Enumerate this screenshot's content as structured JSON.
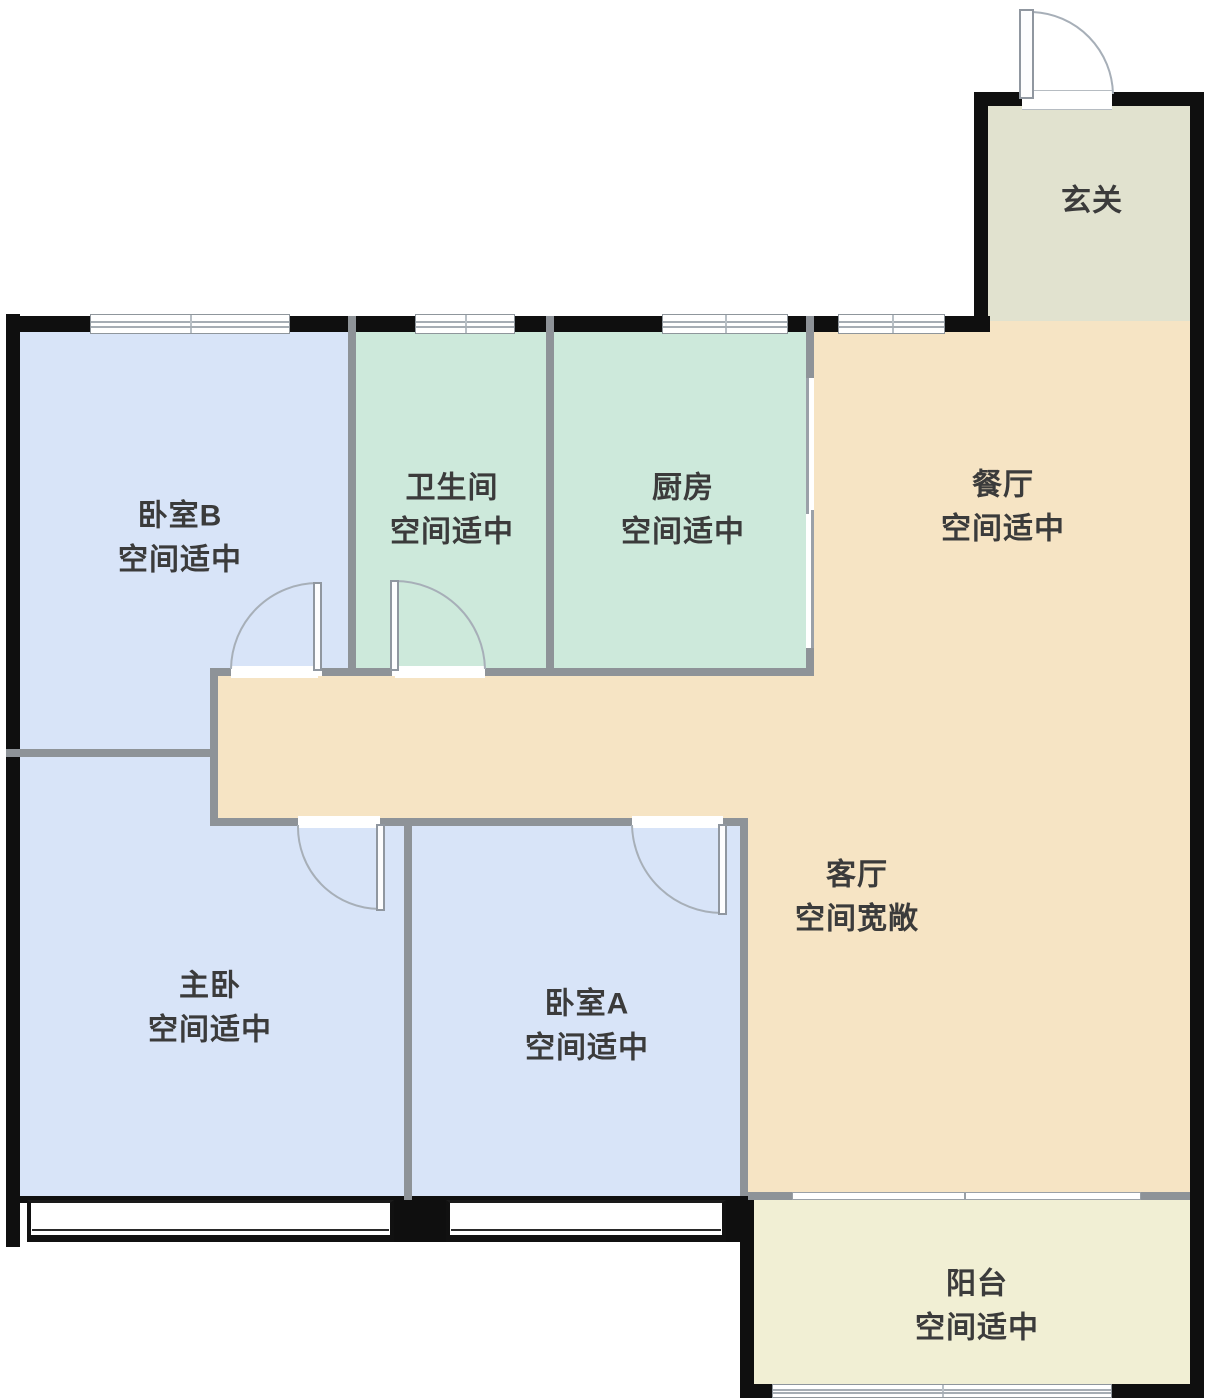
{
  "floorplan": {
    "title": "apartment-floor-plan",
    "rooms": {
      "entry": {
        "name": "玄关",
        "status": ""
      },
      "bedroomB": {
        "name": "卧室B",
        "status": "空间适中"
      },
      "bathroom": {
        "name": "卫生间",
        "status": "空间适中"
      },
      "kitchen": {
        "name": "厨房",
        "status": "空间适中"
      },
      "dining": {
        "name": "餐厅",
        "status": "空间适中"
      },
      "master": {
        "name": "主卧",
        "status": "空间适中"
      },
      "bedroomA": {
        "name": "卧室A",
        "status": "空间适中"
      },
      "living": {
        "name": "客厅",
        "status": "空间宽敞"
      },
      "balcony": {
        "name": "阳台",
        "status": "空间适中"
      }
    },
    "colors": {
      "bedroom_fill": "#d8e4f8",
      "kitchen_bath_fill": "#cde9db",
      "living_dining_fill": "#f6e4c4",
      "entry_fill": "#e1e2cf",
      "balcony_fill": "#f1efd4",
      "exterior_wall": "#0f0f0f",
      "interior_wall": "#8e9398",
      "label_text": "#3b3b3b"
    }
  }
}
